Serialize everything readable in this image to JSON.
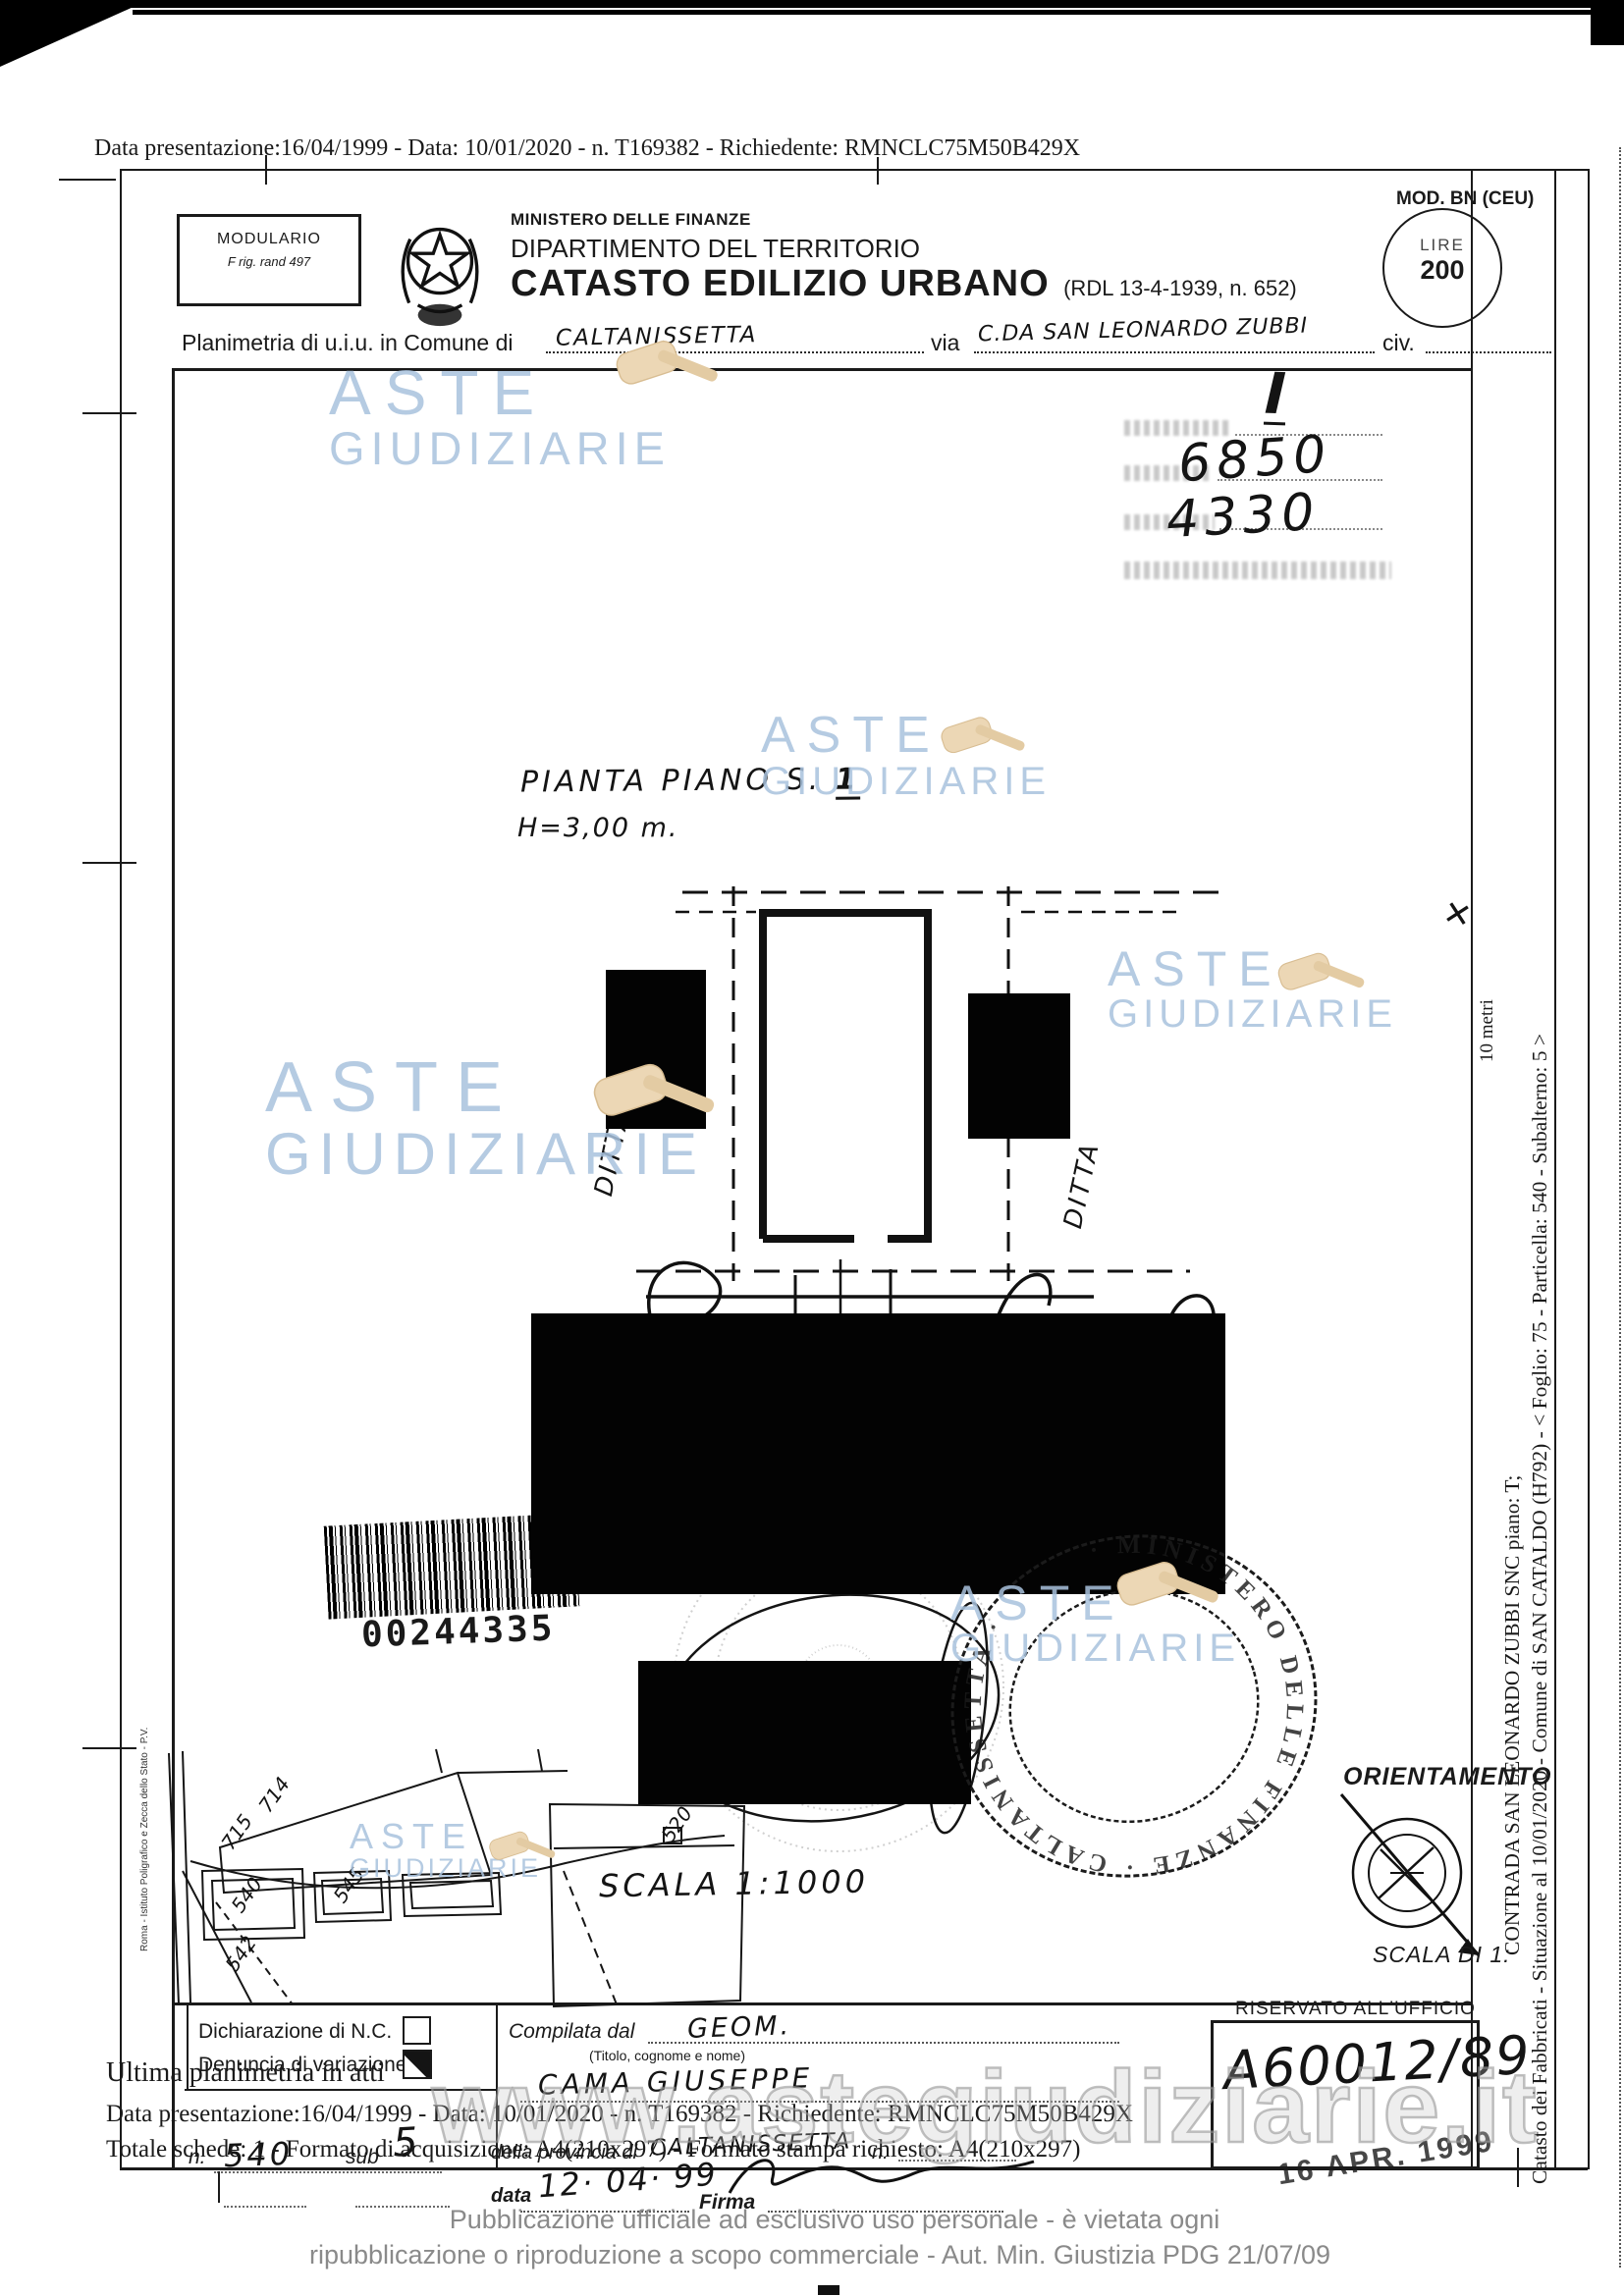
{
  "colors": {
    "ink": "#1a1a1a",
    "watermark_blue": "#a9c2dd",
    "gavel_tan": "#ecd7b5",
    "footer_gray": "#8a8a8a"
  },
  "scan": {
    "top_line": "Data presentazione:16/04/1999 - Data: 10/01/2020 - n. T169382 - Richiedente: RMNCLC75M50B429X"
  },
  "header": {
    "modulario_title": "MODULARIO",
    "modulario_sub": "F rig. rand 497",
    "ministry": "MINISTERO DELLE FINANZE",
    "department": "DIPARTIMENTO DEL TERRITORIO",
    "title": "CATASTO EDILIZIO URBANO",
    "title_ref": "(RDL 13-4-1939, n. 652)",
    "mod_label": "MOD. BN (CEU)",
    "lire_label": "LIRE",
    "lire_value": "200"
  },
  "intro": {
    "comune_label": "Planimetria di u.i.u. in Comune di",
    "comune_value": "CALTANISSETTA",
    "via_label": "via",
    "via_value": "C.DA SAN LEONARDO ZUBBI",
    "civ_label": "civ."
  },
  "ref_block": {
    "row1": "I",
    "row2": "6850",
    "row3": "4330"
  },
  "plan": {
    "title": "PIANTA PIANO S.",
    "title_num": "1",
    "height_note": "H=3,00 m.",
    "ditta_left": "DITTA",
    "ditta_right": "DITTA",
    "scale_note": "SCALA 1:1000",
    "cross_mark": "✕"
  },
  "barcode": {
    "number": "00244335"
  },
  "stamps": {
    "ring_text": "· MINISTERO DELLE FINANZE · CALTANISSETTA ·",
    "date_stamp": "16 APR. 1999"
  },
  "orientation": {
    "label": "ORIENTAMENTO",
    "scale_label": "SCALA DI 1:"
  },
  "sidebar": {
    "line1": "Catasto dei Fabbricati - Situazione al 10/01/2020 - Comune di SAN CATALDO (H792) - < Foglio: 75 - Particella: 540 - Subalterno: 5 >",
    "line2": "CONTRADA SAN LEONARDO ZUBBI SNC piano: T;",
    "scale_bar_label": "10 metri"
  },
  "map": {
    "labels": [
      "715",
      "714",
      "540",
      "545",
      "542",
      "520"
    ],
    "edge_caption": "Roma - Istituto Poligrafico e Zecca dello Stato - P.V."
  },
  "bottom": {
    "decl_nc": "Dichiarazione di N.C.",
    "decl_var": "Denuncia di variazione",
    "ultima": "Ultima planimetria in atti",
    "data_line": "Data presentazione:16/04/1999 - Data: 10/01/2020 - n. T169382 - Richiedente: RMNCLC75M50B429X",
    "totale_line": "Totale schede: 1 - Formato di acquisizione: A4(210x297) - Formato stampa richiesto: A4(210x297)",
    "compilata_label": "Compilata dal",
    "compilata_value": "GEOM.",
    "titolo_caption": "(Titolo, cognome e nome)",
    "nome_value": "CAMA  GIUSEPPE",
    "provincia_label": "della provincia di",
    "provincia_value": "CALTANISSETTA",
    "n_label": "n.",
    "n_value": "540",
    "sub_label": "sub",
    "sub_value": "5",
    "data_label": "data",
    "data_value": "12· 04· 99",
    "firma_label": "Firma",
    "riservato_label": "RISERVATO ALL'UFFICIO",
    "riservato_value": "A60012/89"
  },
  "watermark": {
    "word1": "ASTE",
    "word2": "GIUDIZIARIE",
    "url": "www.astegiudiziarie.it"
  },
  "footer": {
    "line1": "Pubblicazione ufficiale ad esclusivo uso personale - è vietata ogni",
    "line2": "ripubblicazione o riproduzione a scopo commerciale - Aut. Min. Giustizia PDG 21/07/09"
  }
}
